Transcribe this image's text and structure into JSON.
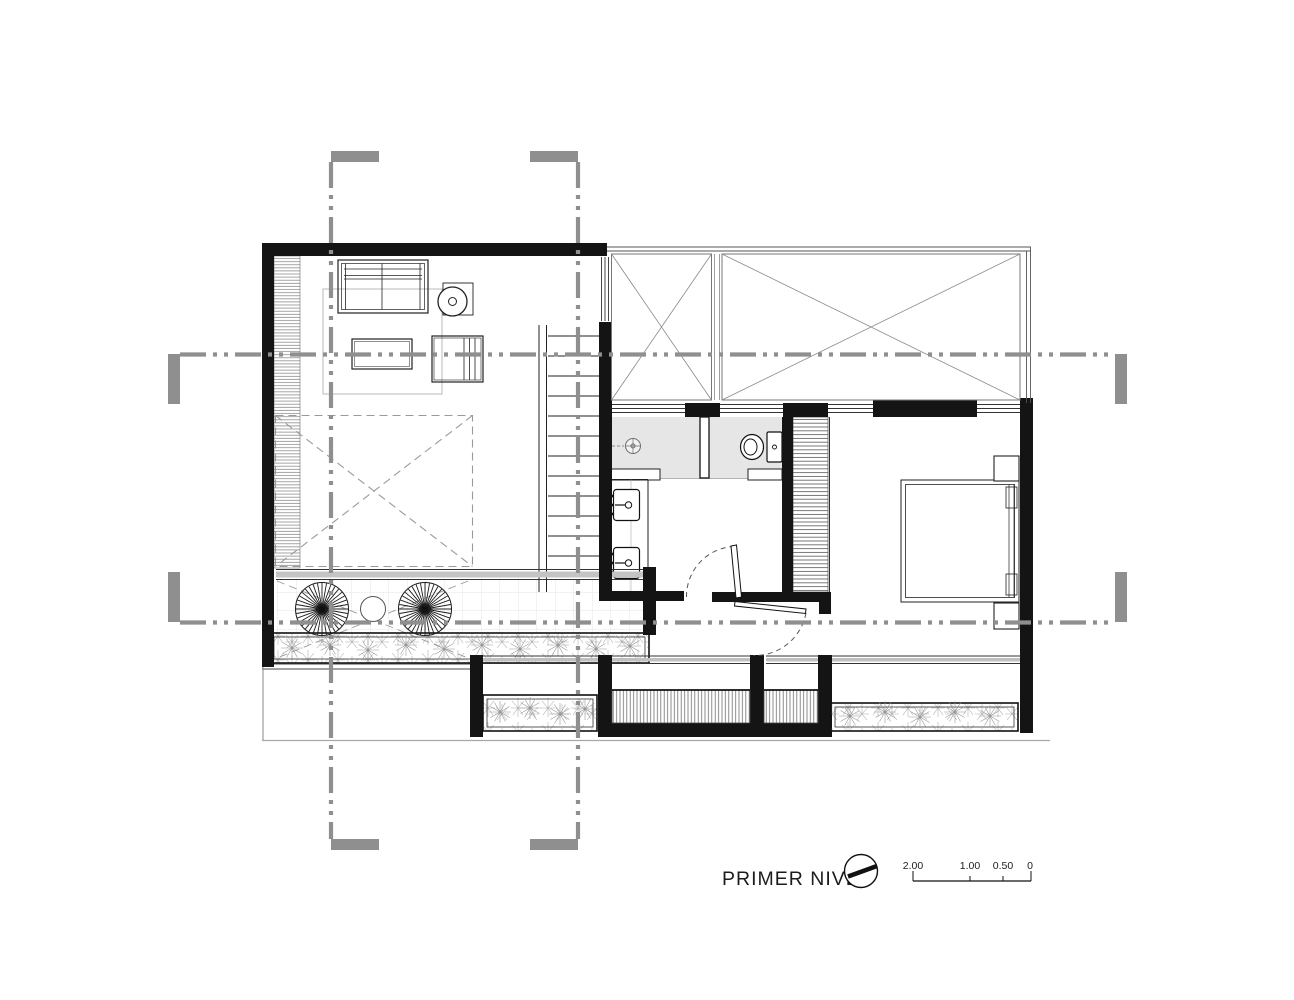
{
  "title": "PRIMER NIVEL",
  "north_indicator": {
    "icon": "compass-needle-icon"
  },
  "scale_bar": {
    "labels": [
      "2.00",
      "1.00",
      "0.50",
      "0"
    ]
  },
  "colors": {
    "background": "#ffffff",
    "wall": "#141414",
    "grid_line": "#8f8f8f",
    "wet_area_fill": "#e6e6e6",
    "glass_gray": "#c4c4c4",
    "drawing_line": "#222222"
  }
}
